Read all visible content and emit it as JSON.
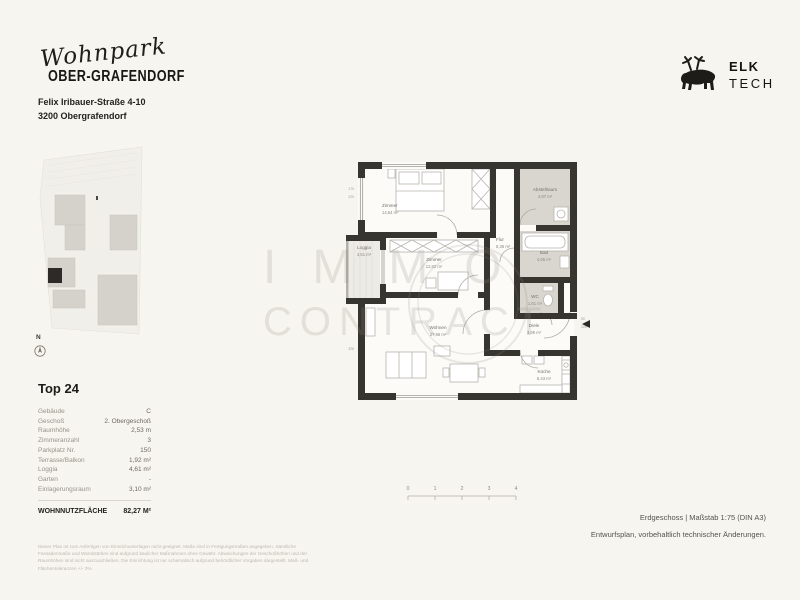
{
  "header": {
    "brand_script": "Wohnpark",
    "brand_name": "OBER-GRAFENDORF",
    "address_line1": "Felix Iribauer-Straße 4-10",
    "address_line2": "3200 Obergrafendorf"
  },
  "logo": {
    "line1": "ELK",
    "line2": "TECH"
  },
  "site_plan": {
    "north_label": "N"
  },
  "unit": {
    "title": "Top 24",
    "rows": [
      {
        "label": "Gebäude",
        "value": "C"
      },
      {
        "label": "Geschoß",
        "value": "2. Obergeschoß"
      },
      {
        "label": "Raumhöhe",
        "value": "2,53 m"
      },
      {
        "label": "Zimmeranzahl",
        "value": "3"
      },
      {
        "label": "Parkplatz Nr.",
        "value": "150"
      },
      {
        "label": "Terrasse/Balkon",
        "value": "1,92 m²"
      },
      {
        "label": "Loggia",
        "value": "4,61 m²"
      },
      {
        "label": "Garten",
        "value": "-"
      },
      {
        "label": "Einlagerungsraum",
        "value": "3,10 m²"
      }
    ],
    "total_label": "WOHNNUTZFLÄCHE",
    "total_value": "82,27 M²"
  },
  "floor_plan": {
    "rooms": [
      {
        "name": "Zimmer",
        "area": "14,64 m²"
      },
      {
        "name": "Abstellraum",
        "area": "4,87 m²"
      },
      {
        "name": "Zimmer",
        "area": "12,82 m²"
      },
      {
        "name": "Flur",
        "area": "8,36 m²"
      },
      {
        "name": "Bad",
        "area": "4,65 m²"
      },
      {
        "name": "WC",
        "area": "1,61 m²"
      },
      {
        "name": "Diele",
        "area": "3,95 m²"
      },
      {
        "name": "Wohnen",
        "area": "27,96 m²"
      },
      {
        "name": "Küche",
        "area": "5,43 m²"
      },
      {
        "name": "Loggia",
        "area": "4,61 m²"
      }
    ],
    "dimensions": [
      "170",
      "220",
      "328",
      "90",
      "226"
    ],
    "scale_ticks": [
      "0",
      "1",
      "2",
      "3",
      "4"
    ]
  },
  "watermark": {
    "line1": "IMMO",
    "line2": "CONTRACT"
  },
  "footer": {
    "plan_info": "Erdgeschoss | Maßstab 1:75 (DIN A3)",
    "revision_note": "Entwurfsplan, vorbehaltlich technischer Änderungen.",
    "disclaimer": "Dieser Plan ist zum Anfertigen von Einreichunterlagen nicht geeignet. Maße sind in Fertigungsmaßen angegeben. Sämtliche Fassadenmaße und Wandstärken sind aufgrund baulicher Maßnahmen ohne Gewähr. Abweichungen der Geschoßhöhen und der Raumhöhen sind nicht auszuschließen. Die Einrichtung ist nur schematisch aufgrund behördlicher Vorgaben dargestellt. Maß- und Flächentoleranzen +/- 3%."
  },
  "colors": {
    "page_bg": "#f7f5ef",
    "wall_dark": "#37352f",
    "room_gray": "#d9d6d0"
  }
}
